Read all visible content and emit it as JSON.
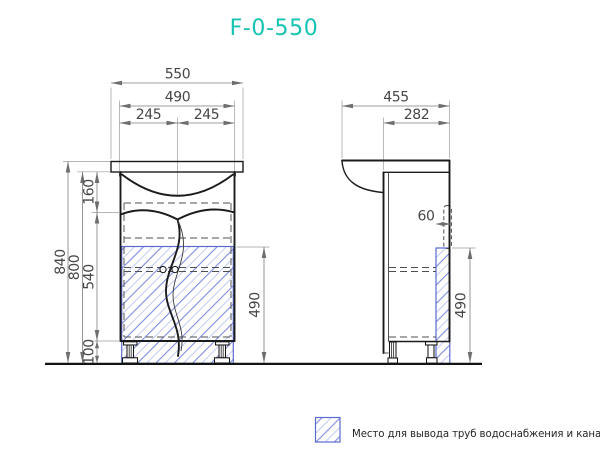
{
  "title": "F-0-550",
  "front_view": {
    "dims": {
      "overall_width": "550",
      "cabinet_width": "490",
      "left_half": "245",
      "right_half": "245",
      "overall_height": "840",
      "cabinet_height": "800",
      "apron_height": "160",
      "door_height": "540",
      "leg_height": "100",
      "pipe_zone_height": "490"
    }
  },
  "side_view": {
    "dims": {
      "overall_depth": "455",
      "cabinet_depth": "282",
      "pipe_zone_depth": "60",
      "pipe_zone_height": "490"
    }
  },
  "legend": {
    "pipe_zone_label": "Место для вывода труб водоснабжения и канализации"
  },
  "colors": {
    "accent_title": "#16c3b3",
    "hatch_blue": "#7e8bdf",
    "hatch_border": "#5b6ad0",
    "drawing_line": "#1b1b1b",
    "dimension_text": "#474747"
  }
}
